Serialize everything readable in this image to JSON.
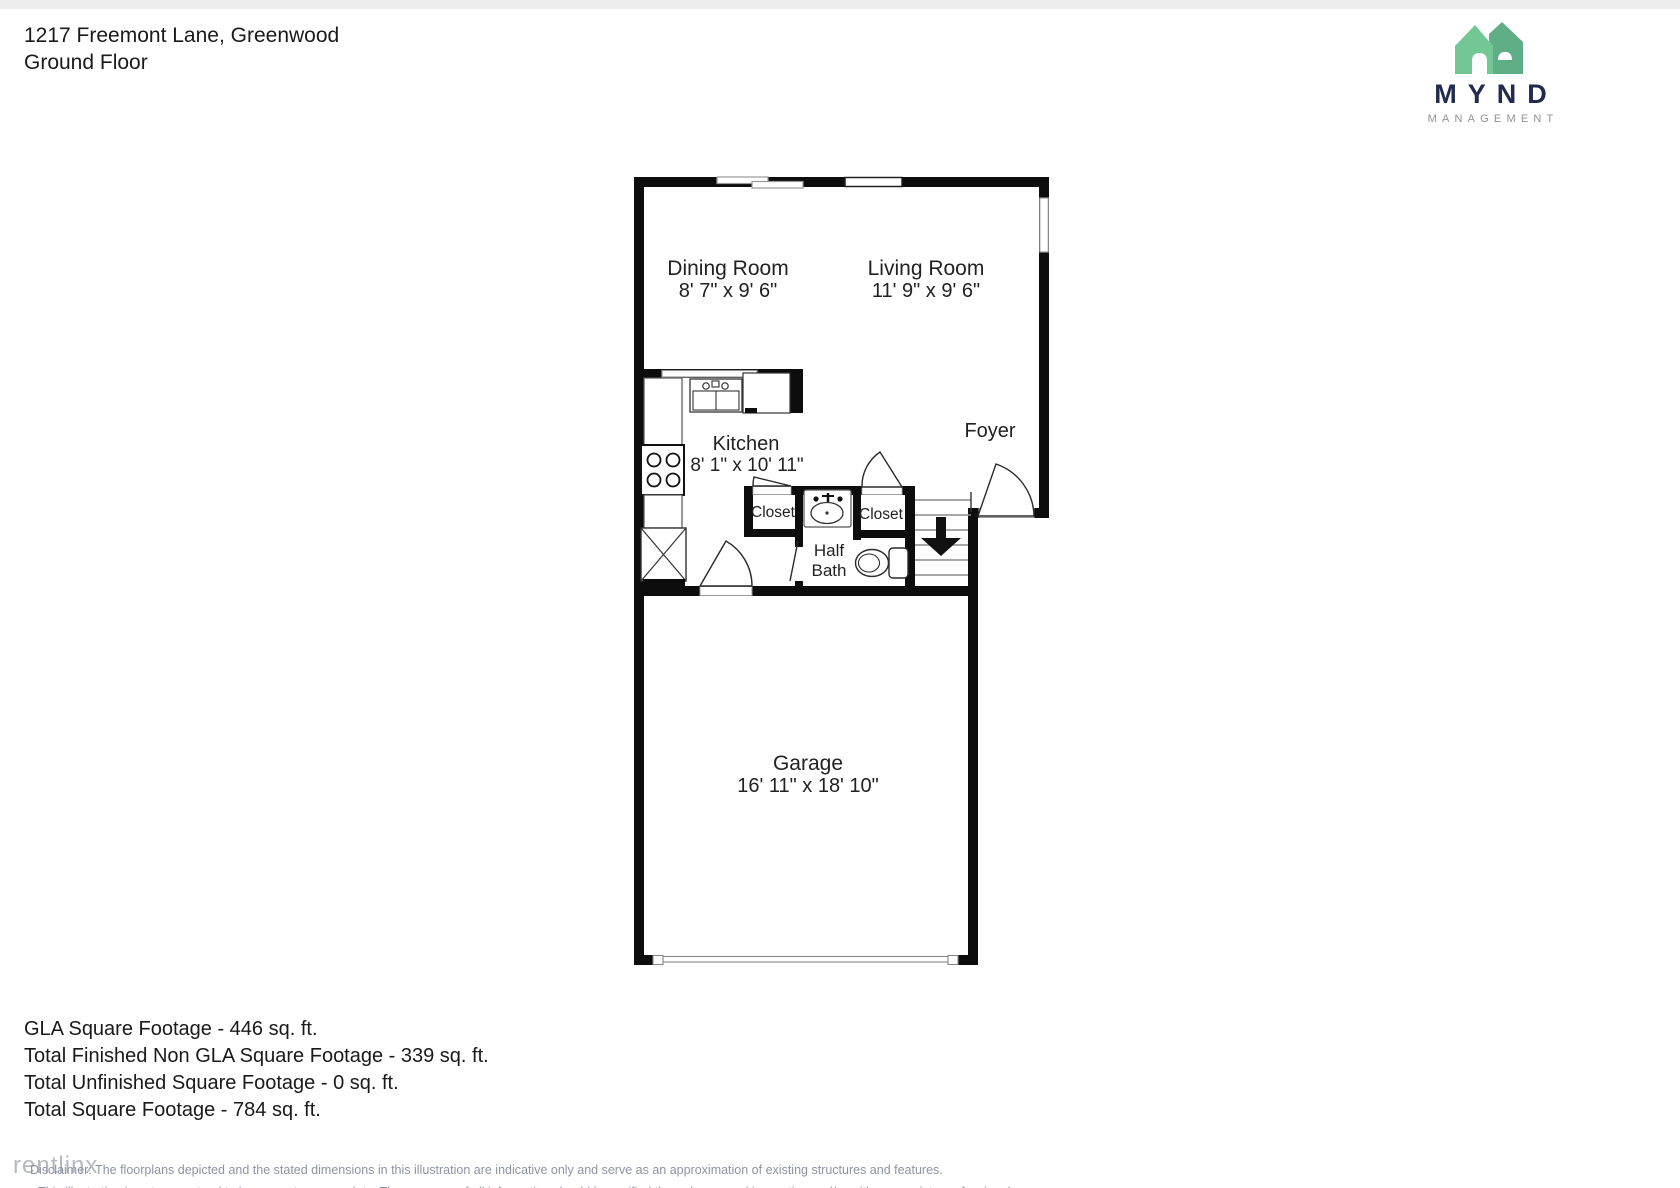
{
  "header": {
    "address": "1217 Freemont Lane, Greenwood",
    "floor": "Ground Floor"
  },
  "logo": {
    "title": "MYND",
    "subtitle": "MANAGEMENT",
    "colors": {
      "house_light": "#72C794",
      "house_dark": "#5FAE85",
      "title_text": "#202C4E",
      "subtitle_text": "#909396"
    }
  },
  "rooms": {
    "dining": {
      "name": "Dining Room",
      "dims": "8' 7\" x 9' 6\""
    },
    "living": {
      "name": "Living Room",
      "dims": "11' 9\" x 9' 6\""
    },
    "kitchen": {
      "name": "Kitchen",
      "dims": "8' 1\" x 10' 11\""
    },
    "foyer": {
      "name": "Foyer"
    },
    "closet_left": {
      "name": "Closet"
    },
    "closet_right": {
      "name": "Closet"
    },
    "half_bath": {
      "name": "Half Bath",
      "lines": [
        "Half",
        "Bath"
      ]
    },
    "garage": {
      "name": "Garage",
      "dims": "16' 11\" x 18' 10\""
    }
  },
  "footer": {
    "lines": [
      "GLA Square Footage - 446 sq. ft.",
      "Total Finished Non GLA Square Footage - 339 sq. ft.",
      "Total Unfinished Square Footage - 0 sq. ft.",
      "Total Square Footage - 784 sq. ft."
    ]
  },
  "disclaimer": {
    "watermark": "rentlinx",
    "line1": "Disclaimer: The floorplans depicted and the stated dimensions in this illustration are indicative only and serve as an approximation of existing structures and features.",
    "line2": "This illustration is not guaranteed to be accurate or complete. The accuracy of all information should be verified through personal inspection and/or with appropriate professionals."
  }
}
